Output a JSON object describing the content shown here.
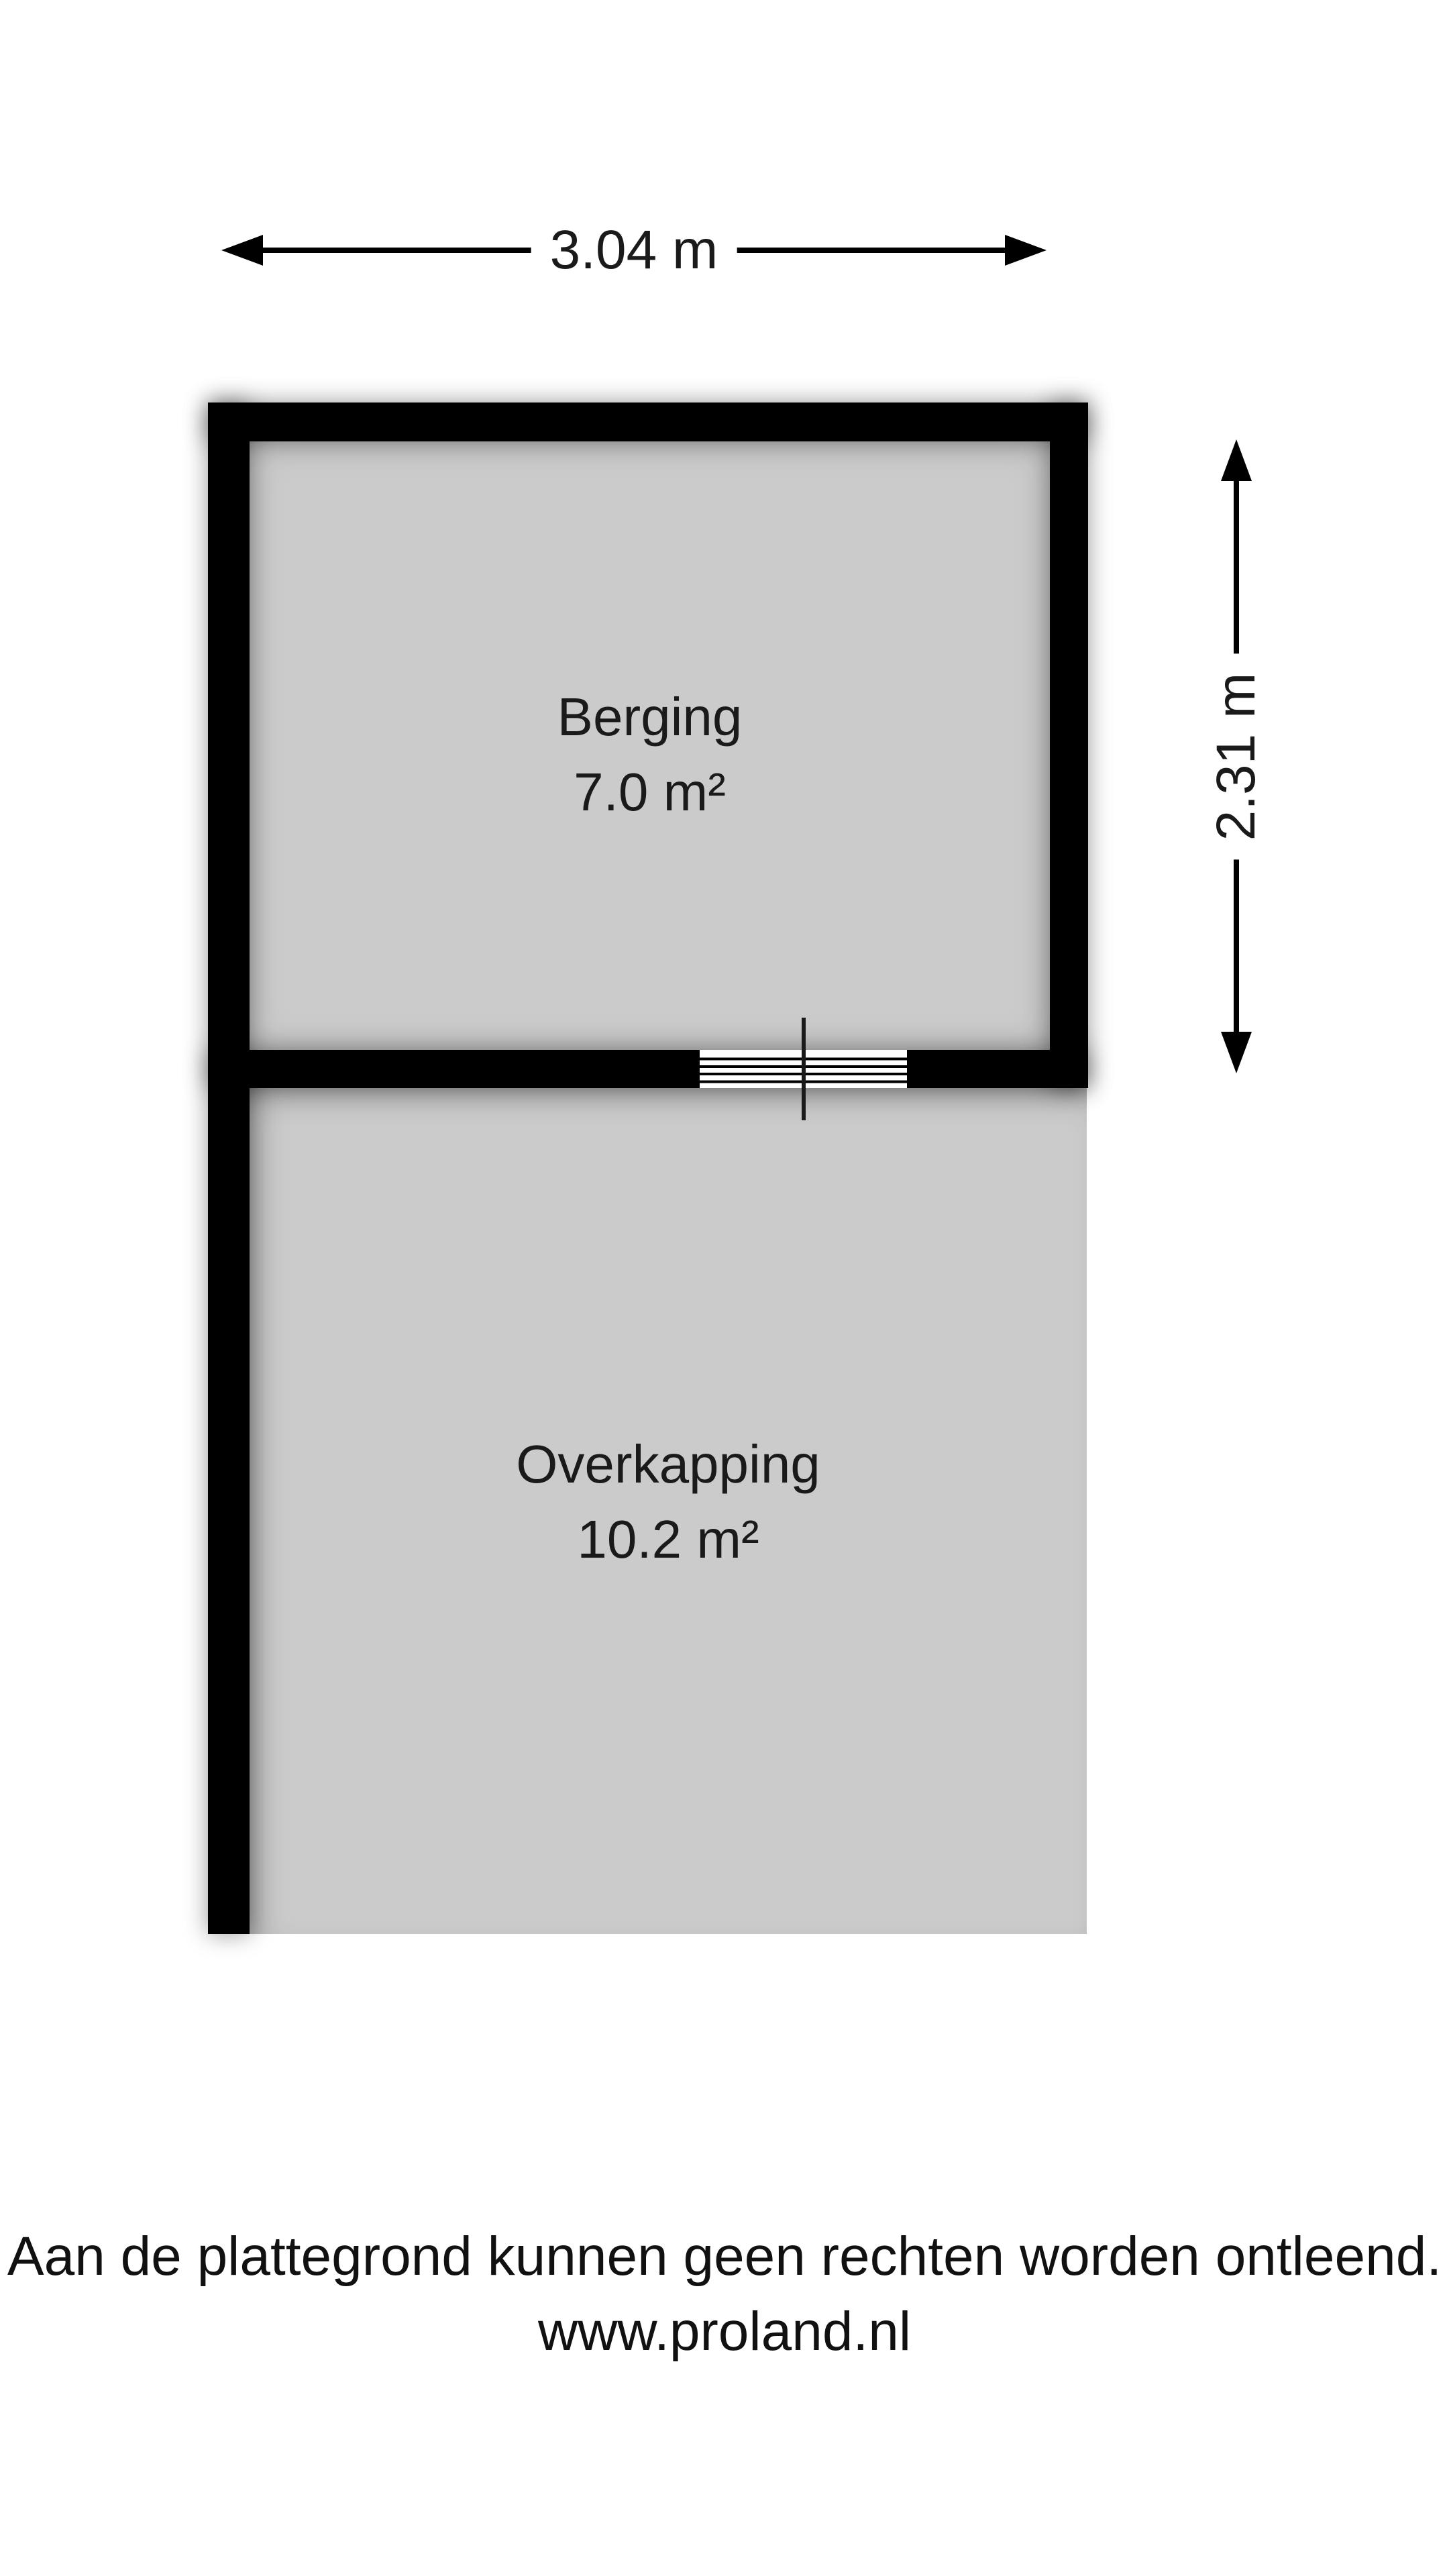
{
  "floorplan": {
    "rooms": [
      {
        "name": "Berging",
        "area": "7.0 m²"
      },
      {
        "name": "Overkapping",
        "area": "10.2 m²"
      }
    ],
    "dimensions": {
      "width_label": "3.04 m",
      "height_label": "2.31 m"
    },
    "symbols": {
      "window_opening": "window-opening-symbol"
    },
    "colors": {
      "wall": "#000000",
      "room_fill": "#cbcbcb",
      "background": "#ffffff",
      "text": "#1a1a1a"
    }
  },
  "footer": {
    "disclaimer": "Aan de plattegrond kunnen geen rechten worden ontleend.",
    "website": "www.proland.nl"
  }
}
